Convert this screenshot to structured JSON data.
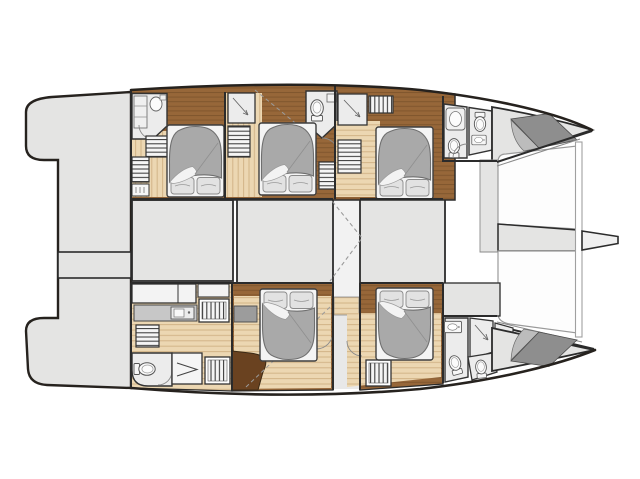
{
  "meta": {
    "description": "Catamaran yacht lower-deck floor plan, bow pointing right, five double cabins with bathrooms",
    "canvas": {
      "width": 640,
      "height": 479
    }
  },
  "colors": {
    "background": "#ffffff",
    "outline": "#26221e",
    "wall": "#2b2b2b",
    "deck": "#e4e4e3",
    "room": "#ececec",
    "fixture": "#f7f7f7",
    "tramp": "#fdfdfd",
    "wood_light": "#ecd7b2",
    "wood_line": "#d2b488",
    "brown": "#976739",
    "brown_line": "#7a4f26",
    "brown_deep": "#6a4220",
    "counter": "#c7c7c7",
    "duvet": "#a9a9a9",
    "duvet_line": "#6f6f6f",
    "linen": "#f4f4f4",
    "pillow": "#e2e2e2",
    "sunpad": "#8e8e8e",
    "sunpad_light": "#bcbcbc",
    "hatch_line": "#3d3d3d",
    "arc": "#8a8a8a",
    "dash": "#9a9a9a"
  },
  "legend": {
    "vessel": "catamaran",
    "orientation": "bow-right",
    "hulls": [
      "top-hull",
      "bottom-hull"
    ],
    "cabins": [
      "cabin-aft-top",
      "cabin-mid-top",
      "cabin-fwd-top",
      "cabin-mid-bottom",
      "cabin-fwd-bottom"
    ],
    "fixture_icons": [
      "double-bed-icon",
      "toilet-icon",
      "washbasin-icon",
      "shower-icon",
      "wardrobe-shelves-icon",
      "stairs-icon",
      "galley-counter-icon",
      "sink-icon",
      "nav-desk-arrow-icon",
      "sunpad-icon",
      "trampoline-icon",
      "bowsprit-icon",
      "swim-platform-icon",
      "aft-crossbeam-icon",
      "mast-dashes-icon"
    ]
  }
}
